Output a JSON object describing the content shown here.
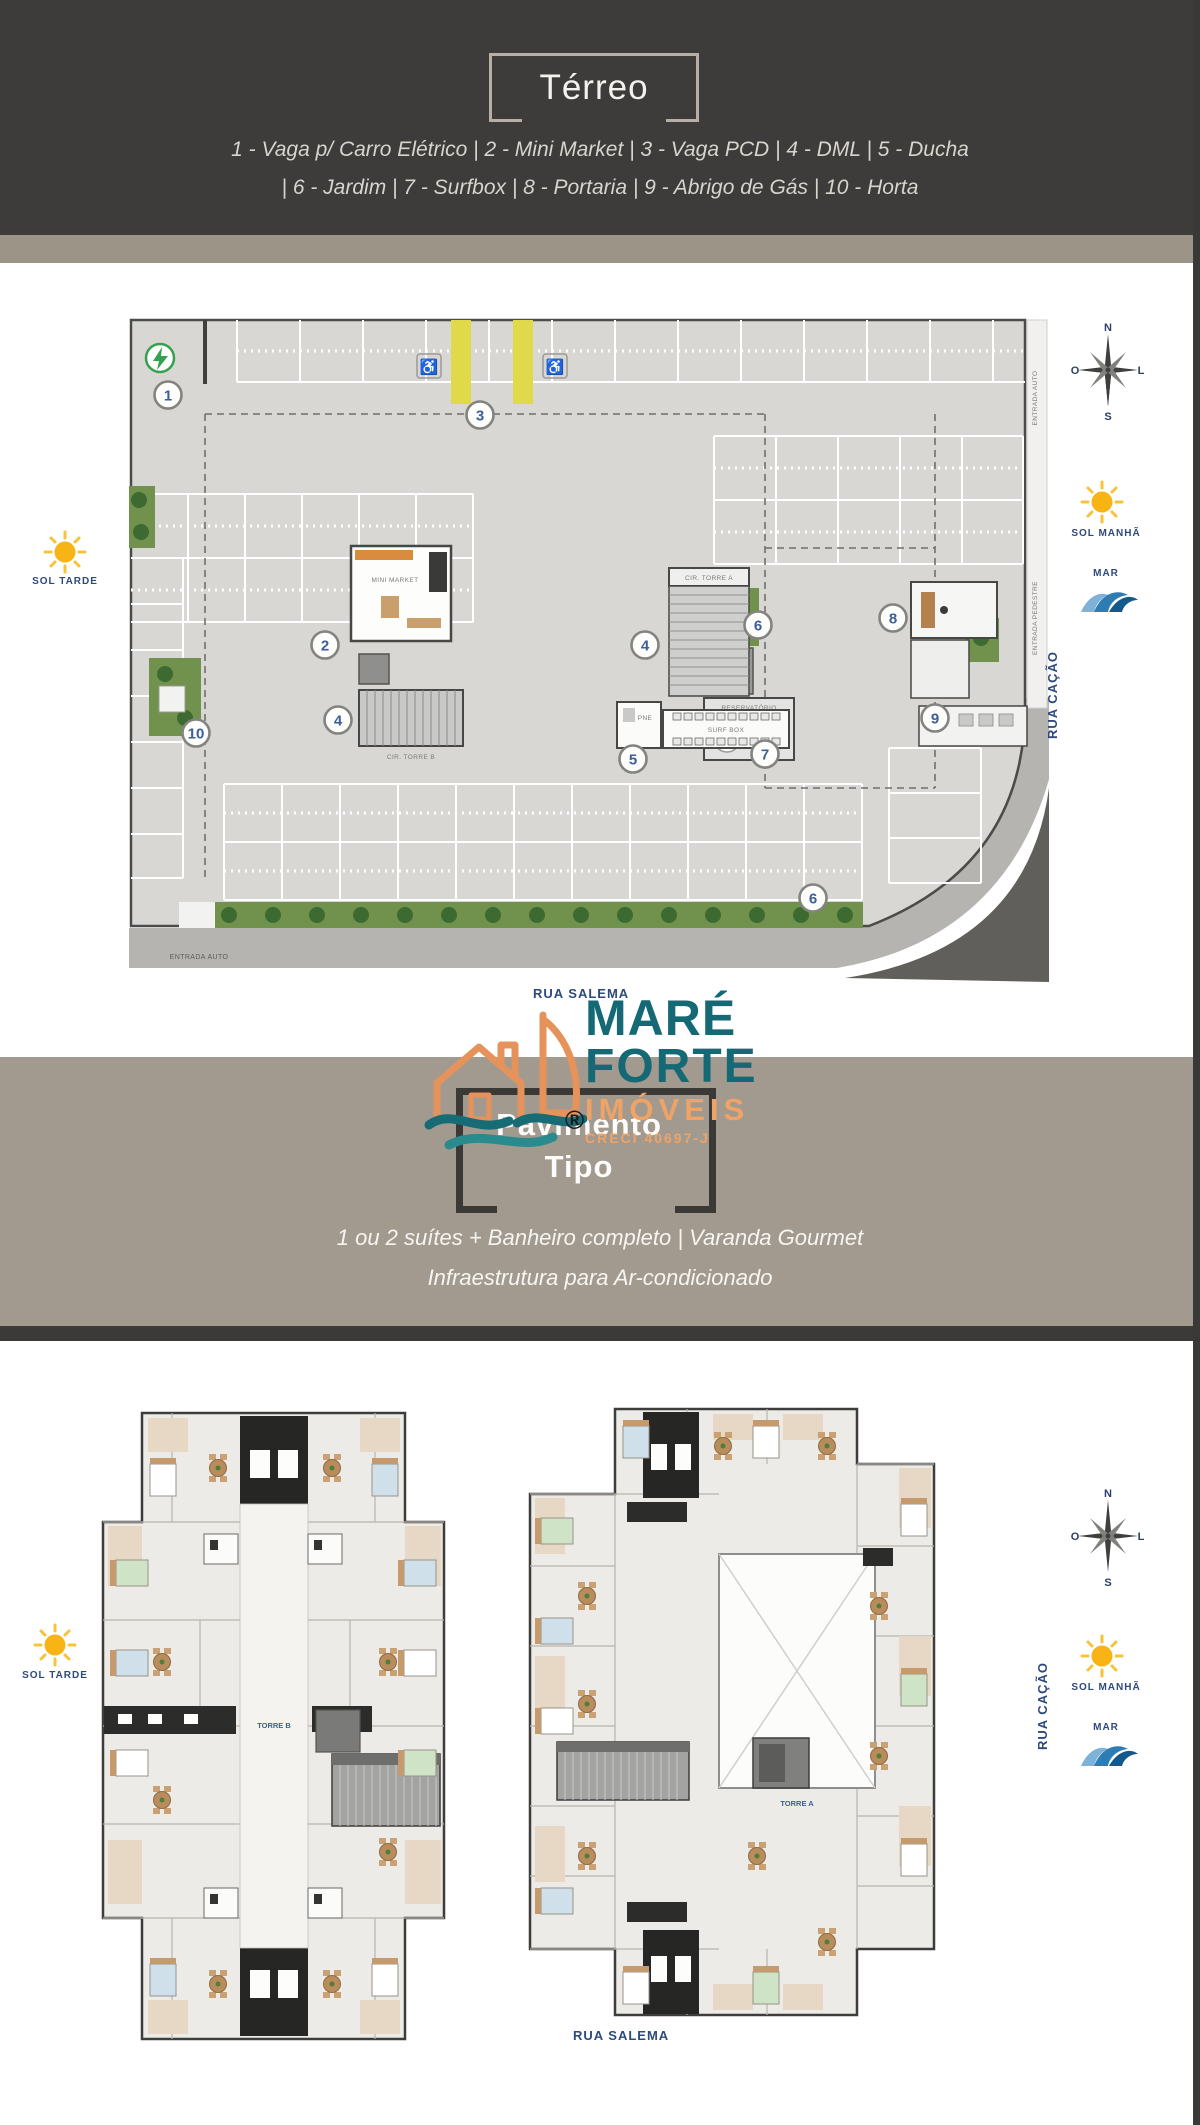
{
  "header": {
    "title": "Térreo",
    "legend_line1": "1 - Vaga p/ Carro Elétrico  |  2 - Mini Market  |  3 - Vaga PCD  |  4 - DML  |  5 - Ducha",
    "legend_line2": "|  6 - Jardim  |  7 - Surfbox |  8 - Portaria  |  9 - Abrigo de Gás  |  10 - Horta"
  },
  "terreo_plan": {
    "circles": [
      {
        "n": "1",
        "x": 39,
        "y": 77
      },
      {
        "n": "2",
        "x": 196,
        "y": 327
      },
      {
        "n": "3",
        "x": 351,
        "y": 97
      },
      {
        "n": "4",
        "x": 209,
        "y": 402
      },
      {
        "n": "4",
        "x": 516,
        "y": 327
      },
      {
        "n": "5",
        "x": 504,
        "y": 441
      },
      {
        "n": "6",
        "x": 629,
        "y": 307
      },
      {
        "n": "6",
        "x": 684,
        "y": 580
      },
      {
        "n": "7",
        "x": 636,
        "y": 436
      },
      {
        "n": "8",
        "x": 764,
        "y": 300
      },
      {
        "n": "9",
        "x": 806,
        "y": 400
      },
      {
        "n": "10",
        "x": 67,
        "y": 415
      }
    ],
    "labels": {
      "mini_market": "MINI MARKET",
      "cir_torre_a": "CIR. TORRE A",
      "cir_torre_b": "CIR. TORRE B",
      "reservatorio_line1": "RESERVATÓRIO",
      "reservatorio_line2": "INFERIOR",
      "surf_box": "SURF BOX",
      "pne": "PNE",
      "entrada_auto_bottom": "ENTRADA AUTO",
      "entrada_auto_side": "ENTRADA AUTO",
      "entrada_pedestre": "ENTRADA PEDESTRE"
    },
    "street_bottom": "RUA SALEMA",
    "street_right": "RUA CAÇÃO"
  },
  "markers": {
    "sol_tarde": "SOL TARDE",
    "sol_manha": "SOL MANHÃ",
    "mar": "MAR",
    "compass": {
      "n": "N",
      "s": "S",
      "o": "O",
      "l": "L"
    }
  },
  "logo": {
    "mare": "MARÉ",
    "forte": "FORTE",
    "imoveis": "IMÓVEIS",
    "creci": "CRECI 40697-J",
    "registered": "®"
  },
  "tipo_section": {
    "title_line1": "Pavimento",
    "title_line2": "Tipo",
    "subtitle_line1": "1 ou 2 suítes + Banheiro completo  |  Varanda Gourmet",
    "subtitle_line2": "Infraestrutura para Ar-condicionado"
  },
  "tipo_plans": {
    "torre_b": "TORRE B",
    "torre_a": "TORRE A",
    "street_bottom": "RUA SALEMA",
    "street_right": "RUA CAÇÃO"
  },
  "palette": {
    "header_dark": "#3d3c3a",
    "band_tan": "#9d9488",
    "logo_teal": "#156974",
    "logo_orange": "#efa366",
    "street_navy": "#2e4a7c",
    "plan_floor": "#d8d7d3",
    "jardim_green": "#71924d",
    "vaga_pcd_yellow": "#e0da4a",
    "sun_yellow": "#f7b414",
    "mar_blue": "#2e7cb4"
  }
}
